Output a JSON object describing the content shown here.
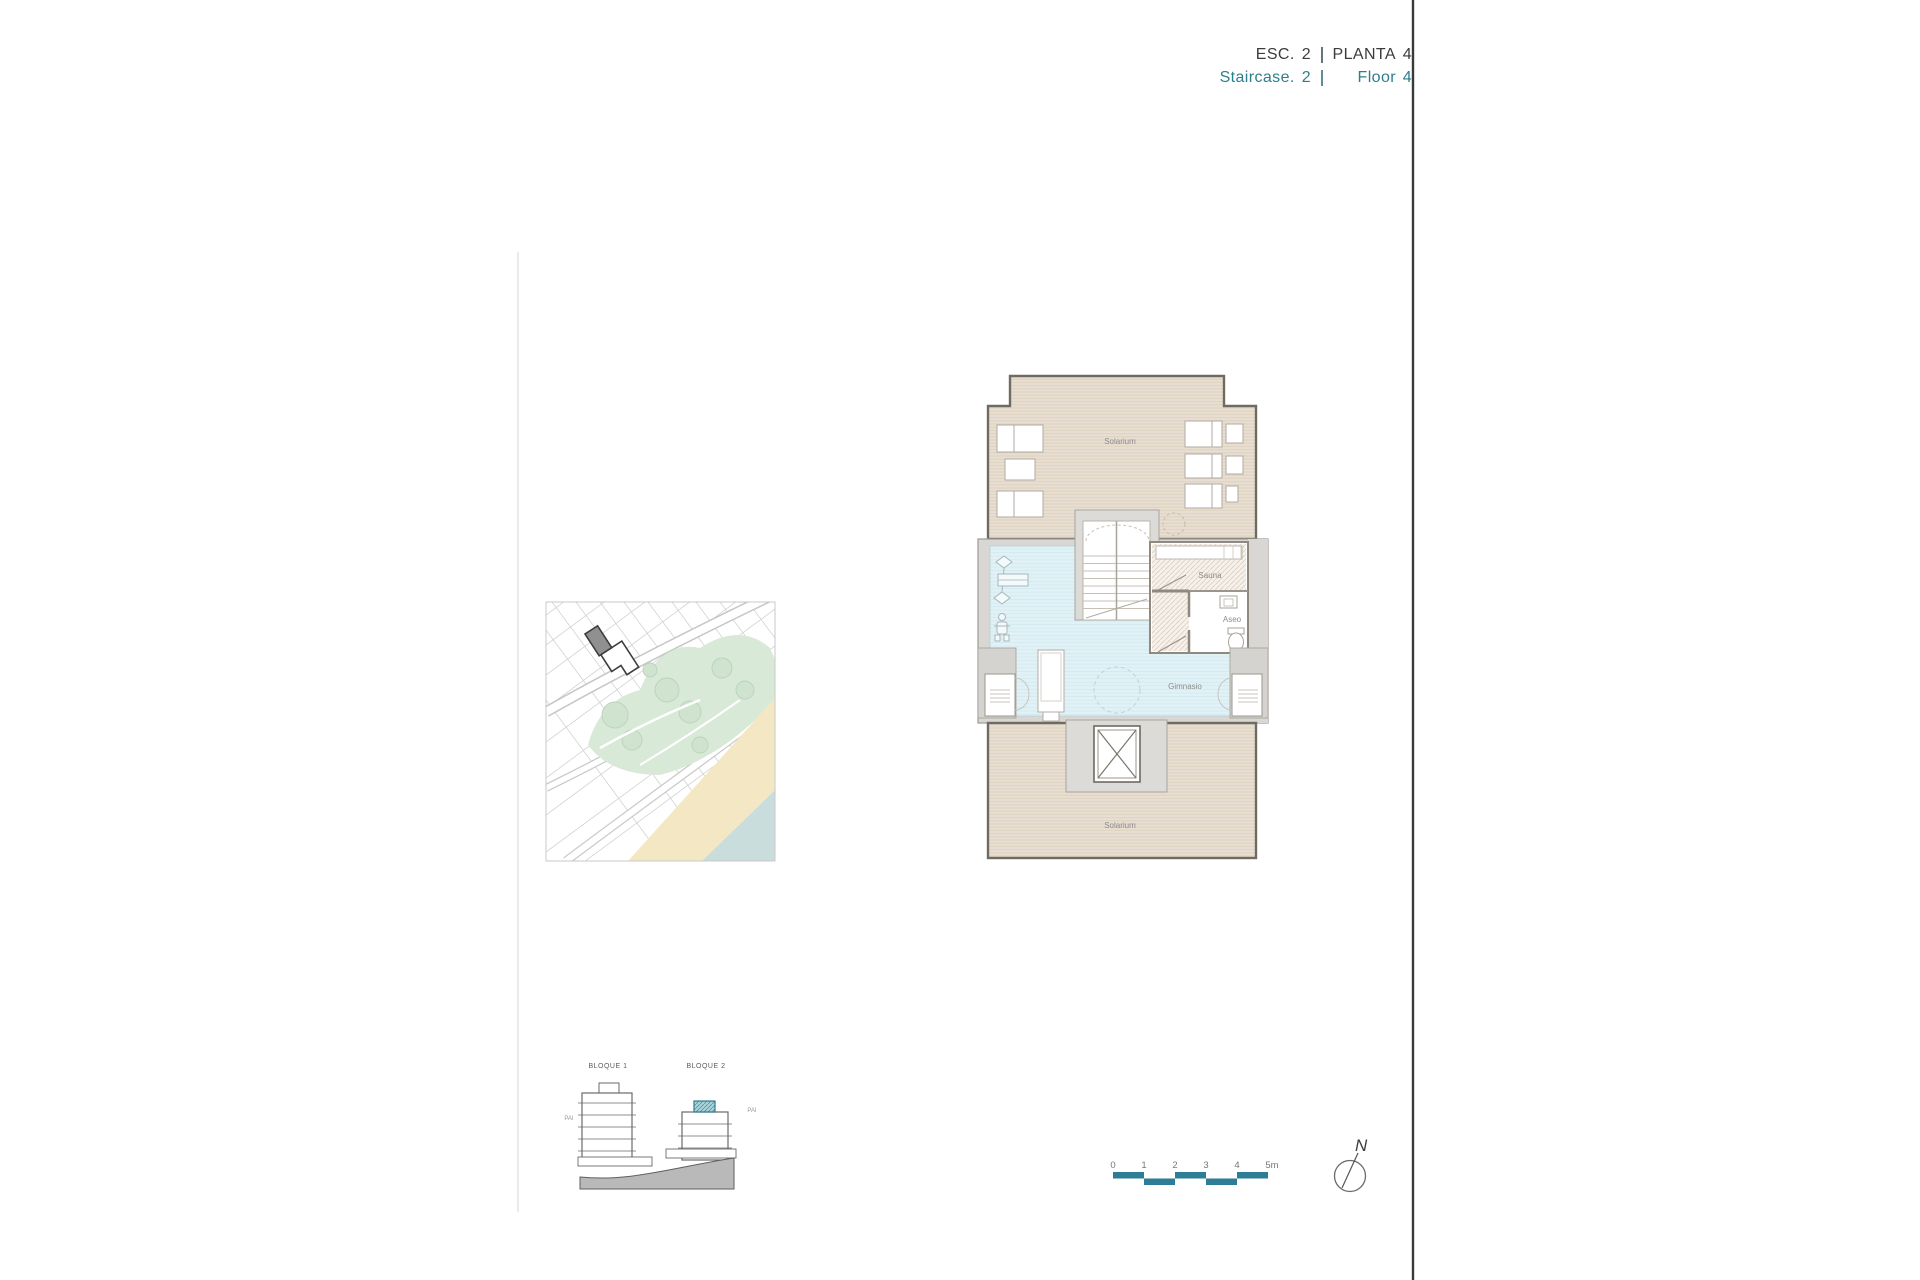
{
  "header": {
    "esc_label": "ESC.",
    "esc_num": "2",
    "planta_label": "PLANTA",
    "planta_num": "4",
    "staircase_label": "Staircase.",
    "staircase_num": "2",
    "floor_label": "Floor",
    "floor_num": "4"
  },
  "floor_plan": {
    "labels": {
      "solarium_top": "Solarium",
      "solarium_bottom": "Solarium",
      "gym": "Gimnasio",
      "sauna": "Sauna",
      "toilet": "Aseo"
    }
  },
  "elevation": {
    "block1_label": "BLOQUE 1",
    "block2_label": "BLOQUE 2",
    "pai_left": "PAI",
    "pai_right": "PAI"
  },
  "scale_bar": {
    "ticks": [
      "0",
      "1",
      "2",
      "3",
      "4",
      "5m"
    ],
    "bar_color": "#2e7d96"
  },
  "compass": {
    "north_label": "N"
  },
  "colors": {
    "accent_teal": "#2e7e8e",
    "scalebar_teal": "#2e7d96",
    "solarium_tan": "#e8dfd2",
    "gym_blue": "#e1f2f7",
    "highlight_teal": "#a9d2da",
    "park_green": "#d8e9d8",
    "sand": "#f4e8c4",
    "sea": "#cadddd"
  }
}
